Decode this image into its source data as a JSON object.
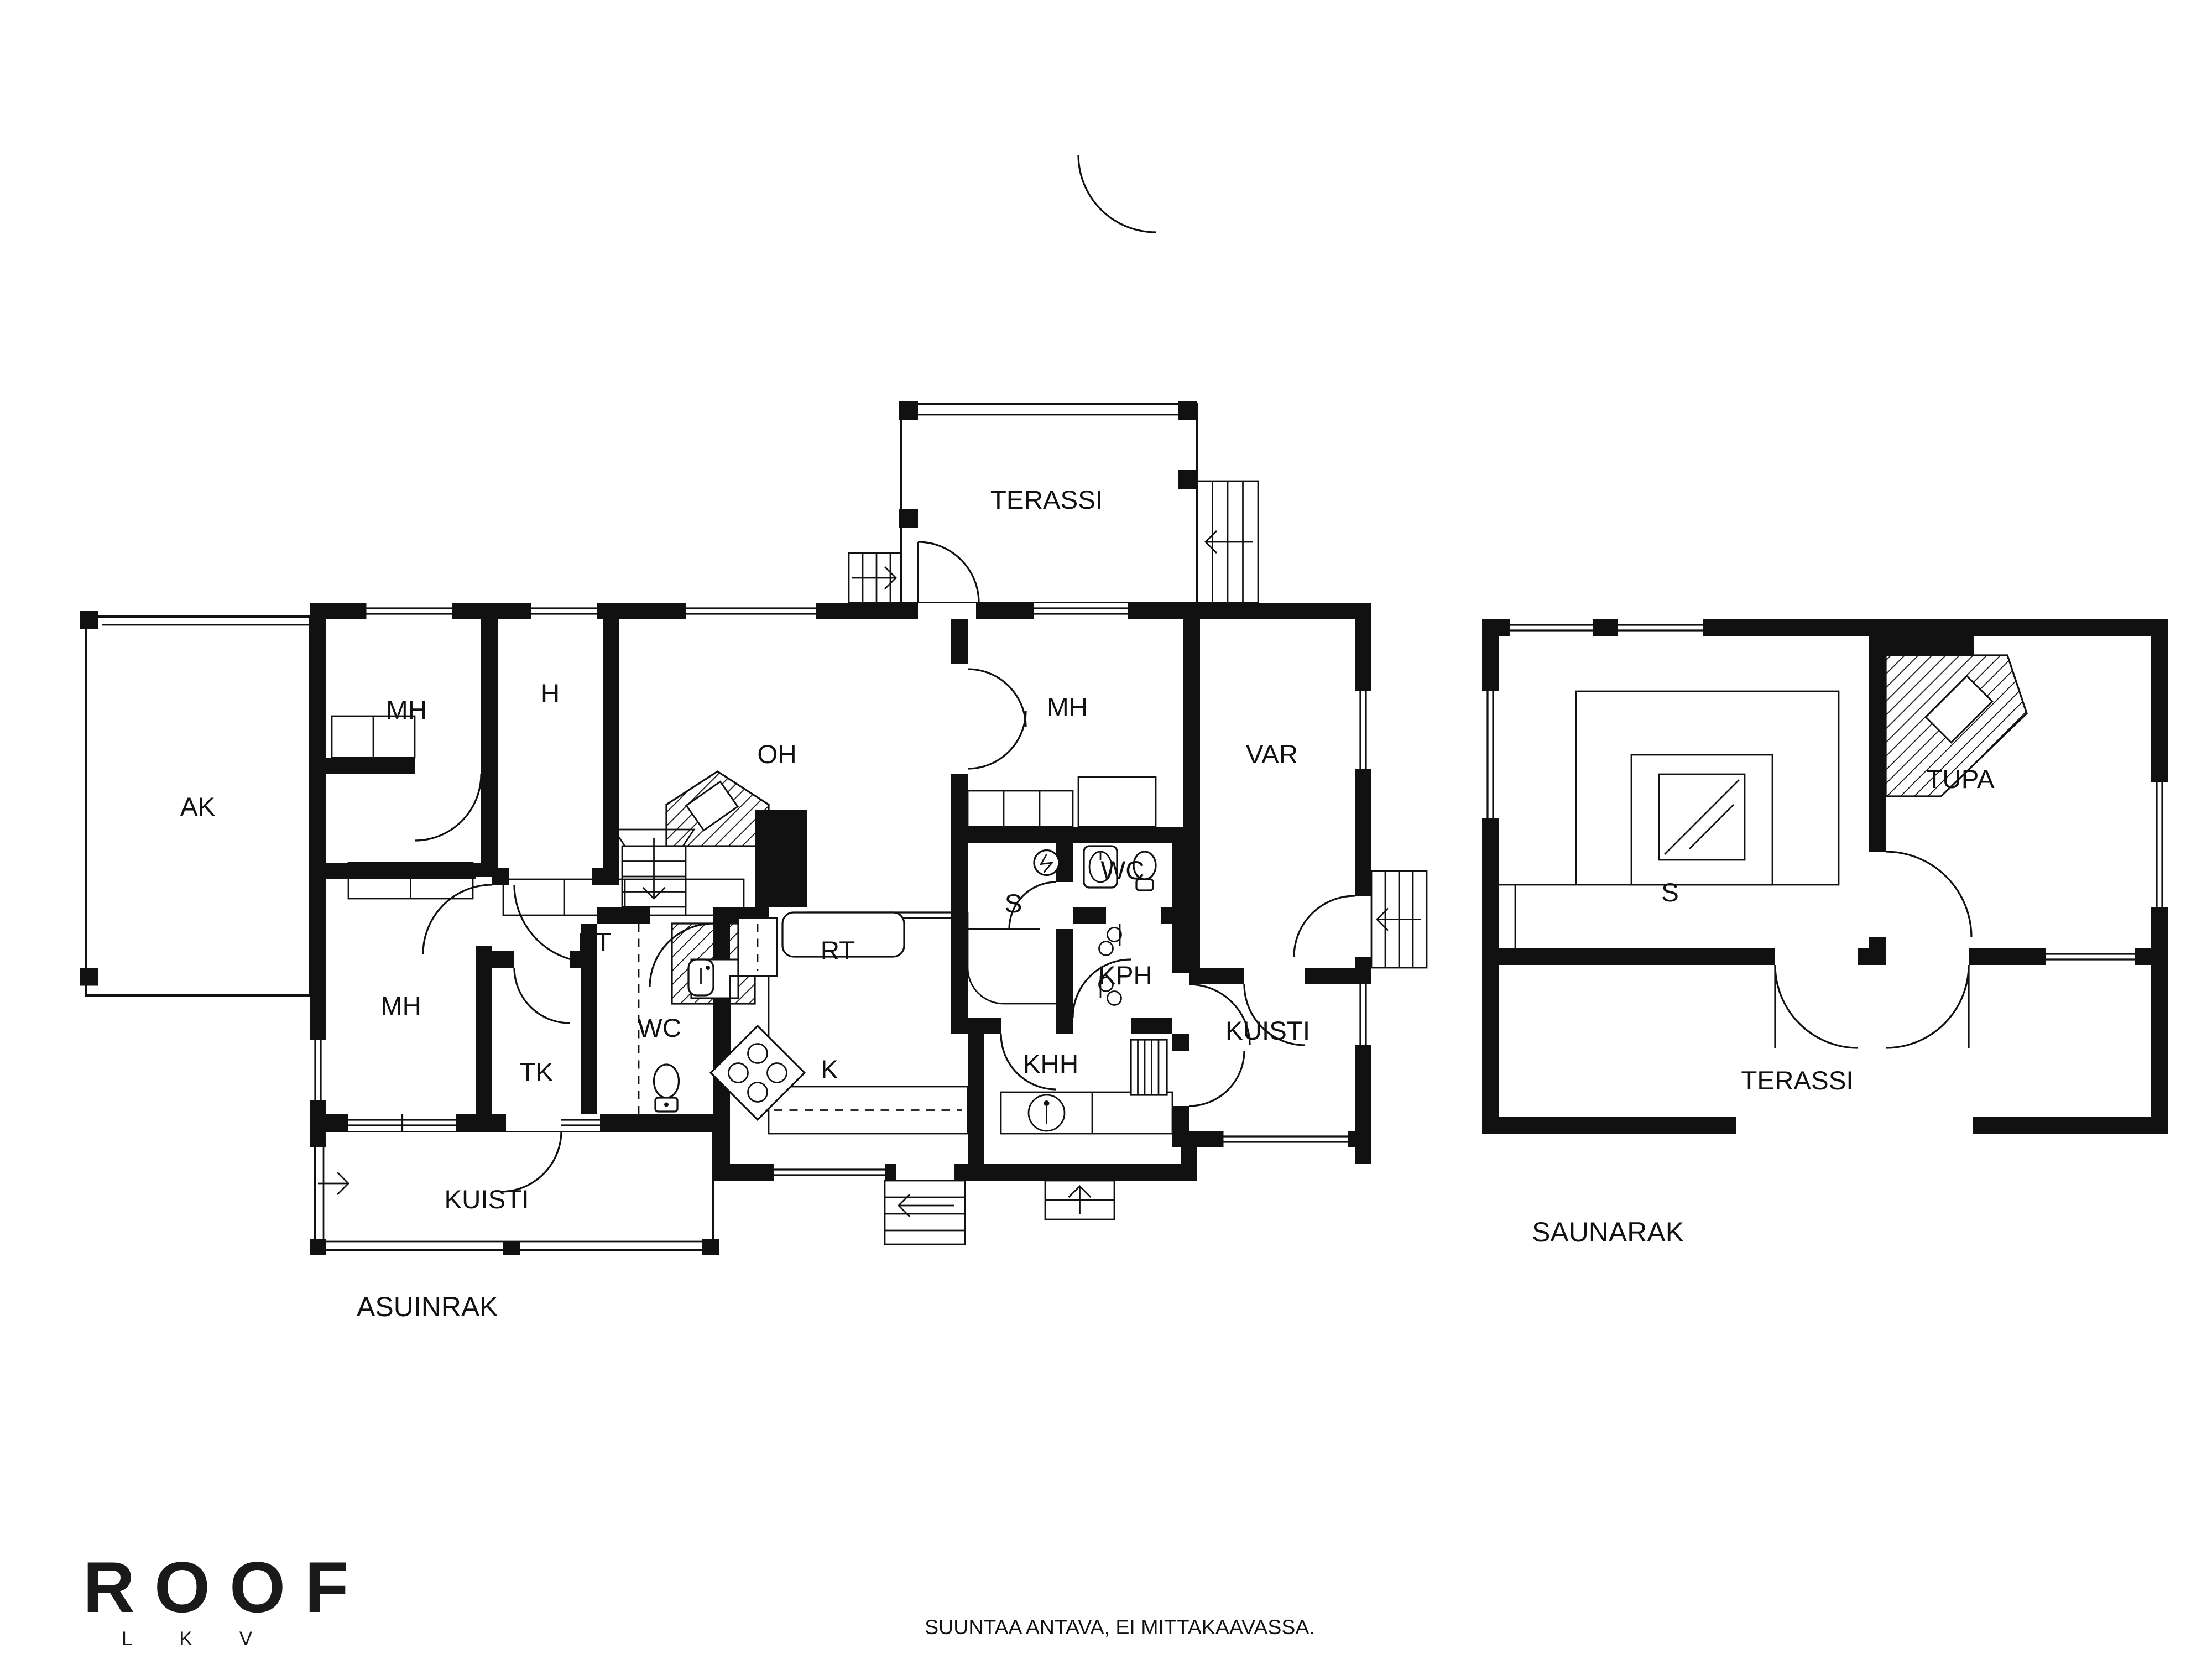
{
  "main_building": {
    "name": "ASUINRAK",
    "rooms": {
      "terassi": "TERASSI",
      "ak": "AK",
      "mh_top_left": "MH",
      "h": "H",
      "oh": "OH",
      "mh_top_right": "MH",
      "var": "VAR",
      "sauna": "S",
      "wc_small": "WC",
      "kph": "KPH",
      "et": "ET",
      "rt": "RT",
      "mh_bottom": "MH",
      "wc_bottom": "WC",
      "tk": "TK",
      "k": "K",
      "khh": "KHH",
      "kuisti_right": "KUISTI",
      "kuisti_front": "KUISTI"
    }
  },
  "sauna_building": {
    "name": "SAUNARAK",
    "rooms": {
      "tupa": "TUPA",
      "sauna": "S",
      "terassi": "TERASSI"
    }
  },
  "footer": {
    "brand": "ROOF",
    "brand_letters": "LKV",
    "disclaimer": "SUUNTAA ANTAVA, EI MITTAKAAVASSA."
  }
}
